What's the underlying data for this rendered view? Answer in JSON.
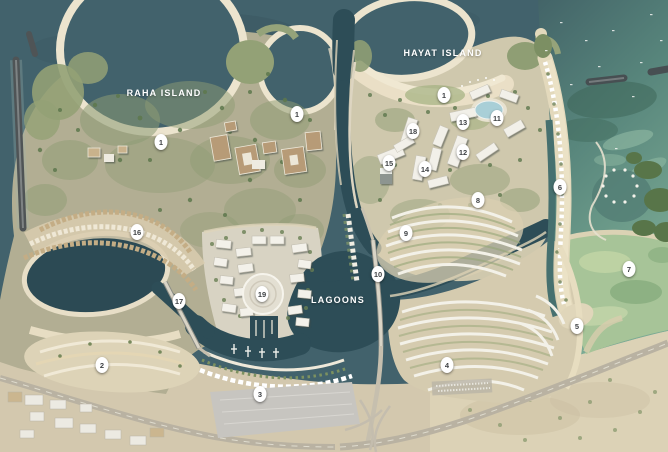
{
  "map": {
    "region_labels": [
      {
        "text": "RAHA ISLAND",
        "x": 164,
        "y": 93
      },
      {
        "text": "HAYAT ISLAND",
        "x": 443,
        "y": 53
      },
      {
        "text": "LAGOONS",
        "x": 338,
        "y": 300
      }
    ],
    "markers": [
      {
        "label": "1",
        "x": 161,
        "y": 142
      },
      {
        "label": "1",
        "x": 297,
        "y": 114
      },
      {
        "label": "1",
        "x": 444,
        "y": 95
      },
      {
        "label": "2",
        "x": 102,
        "y": 365
      },
      {
        "label": "3",
        "x": 260,
        "y": 394
      },
      {
        "label": "4",
        "x": 447,
        "y": 365
      },
      {
        "label": "5",
        "x": 577,
        "y": 326
      },
      {
        "label": "6",
        "x": 560,
        "y": 187
      },
      {
        "label": "7",
        "x": 629,
        "y": 269
      },
      {
        "label": "8",
        "x": 478,
        "y": 200
      },
      {
        "label": "9",
        "x": 406,
        "y": 233
      },
      {
        "label": "10",
        "x": 378,
        "y": 274
      },
      {
        "label": "11",
        "x": 497,
        "y": 118
      },
      {
        "label": "12",
        "x": 463,
        "y": 152
      },
      {
        "label": "13",
        "x": 463,
        "y": 122
      },
      {
        "label": "14",
        "x": 425,
        "y": 169
      },
      {
        "label": "15",
        "x": 389,
        "y": 163
      },
      {
        "label": "16",
        "x": 137,
        "y": 232
      },
      {
        "label": "17",
        "x": 179,
        "y": 301
      },
      {
        "label": "18",
        "x": 413,
        "y": 131
      },
      {
        "label": "19",
        "x": 262,
        "y": 294
      }
    ],
    "colors": {
      "sea_deep": "#42626c",
      "sea_shallow": "#7cab94",
      "canal": "#2d4d57",
      "sand": "#d5cbaf",
      "beach": "#ece4ce",
      "vegetation": "#8d9b74",
      "building_white": "#f2f0e9",
      "building_tan": "#b79b77",
      "marker_bg": "#ffffff",
      "marker_text": "#3f4245",
      "label_text": "#ffffff"
    }
  }
}
